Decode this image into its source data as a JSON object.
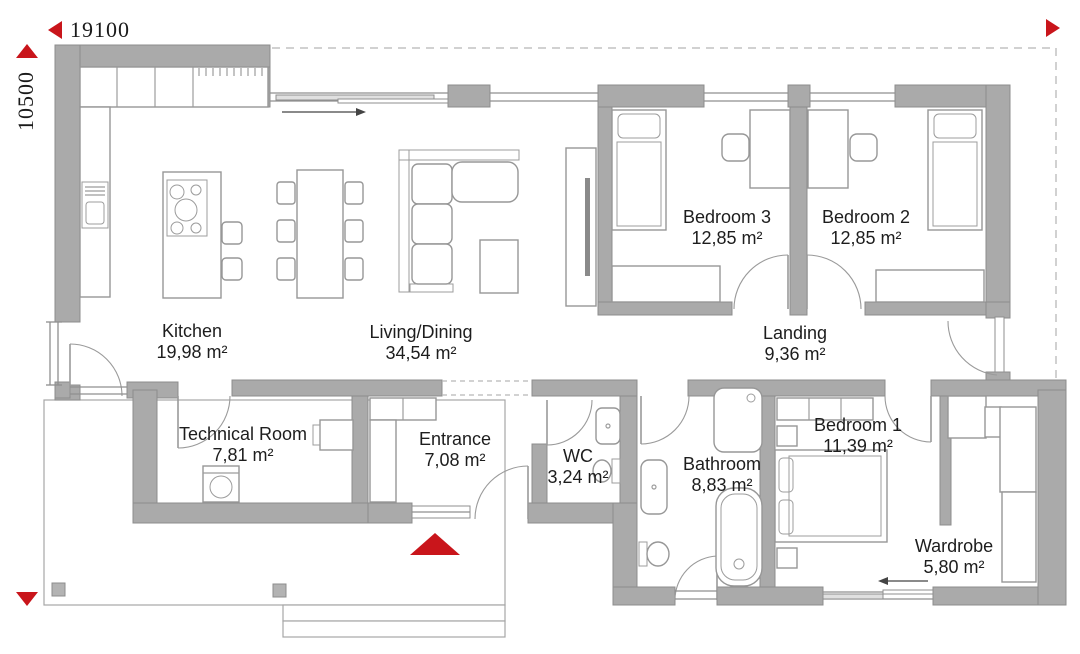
{
  "dimensions": {
    "width": "19100",
    "height": "10500"
  },
  "rooms": {
    "kitchen": {
      "name": "Kitchen",
      "area": "19,98 m²"
    },
    "living": {
      "name": "Living/Dining",
      "area": "34,54 m²"
    },
    "bedroom3": {
      "name": "Bedroom 3",
      "area": "12,85 m²"
    },
    "bedroom2": {
      "name": "Bedroom 2",
      "area": "12,85 m²"
    },
    "landing": {
      "name": "Landing",
      "area": "9,36 m²"
    },
    "technical": {
      "name": "Technical Room",
      "area": "7,81 m²"
    },
    "entrance": {
      "name": "Entrance",
      "area": "7,08 m²"
    },
    "wc": {
      "name": "WC",
      "area": "3,24 m²"
    },
    "bathroom": {
      "name": "Bathroom",
      "area": "8,83 m²"
    },
    "bedroom1": {
      "name": "Bedroom 1",
      "area": "11,39 m²"
    },
    "wardrobe": {
      "name": "Wardrobe",
      "area": "5,80 m²"
    }
  },
  "colors": {
    "wall": "#aaaaaa",
    "wall_outline": "#8c8c8c",
    "accent_red": "#c9151b",
    "furniture_line": "#979797",
    "dashed_outline": "#c2c2c2"
  },
  "icons": {
    "dimension_arrow_left": "left-pointing red triangle",
    "dimension_arrow_right": "right-pointing red triangle",
    "dimension_arrow_up": "up-pointing red triangle",
    "dimension_arrow_down": "down-pointing red triangle",
    "entrance_marker": "up-pointing red triangle",
    "sliding_door_arrow": "thin black arrow"
  }
}
